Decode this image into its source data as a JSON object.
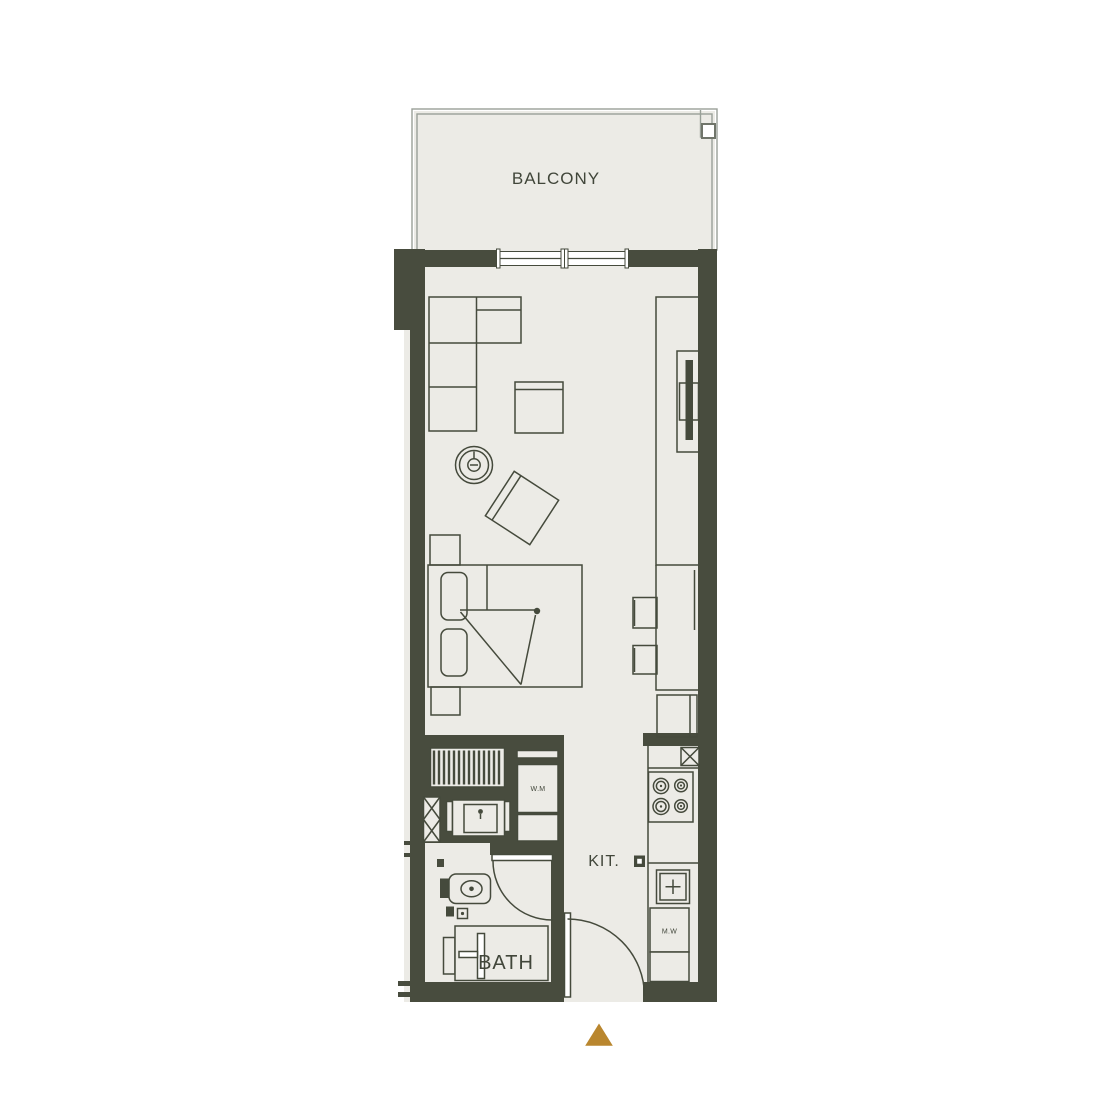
{
  "floor_plan": {
    "rooms": [
      {
        "id": "balcony",
        "label": "BALCONY"
      },
      {
        "id": "kitchen",
        "label": "KIT."
      },
      {
        "id": "bathroom",
        "label": "BATH"
      }
    ],
    "appliances": [
      {
        "id": "washing-machine",
        "label": "W.M"
      },
      {
        "id": "microwave",
        "label": "M.W"
      }
    ]
  },
  "theme": {
    "wall_color": "#484c3e",
    "floor_color": "#ecebe6",
    "line_color": "#454a3c",
    "text_color": "#41463a",
    "accent_color": "#b9862e",
    "balcony_border_color": "#99a098",
    "background_color": "#ffffff"
  }
}
